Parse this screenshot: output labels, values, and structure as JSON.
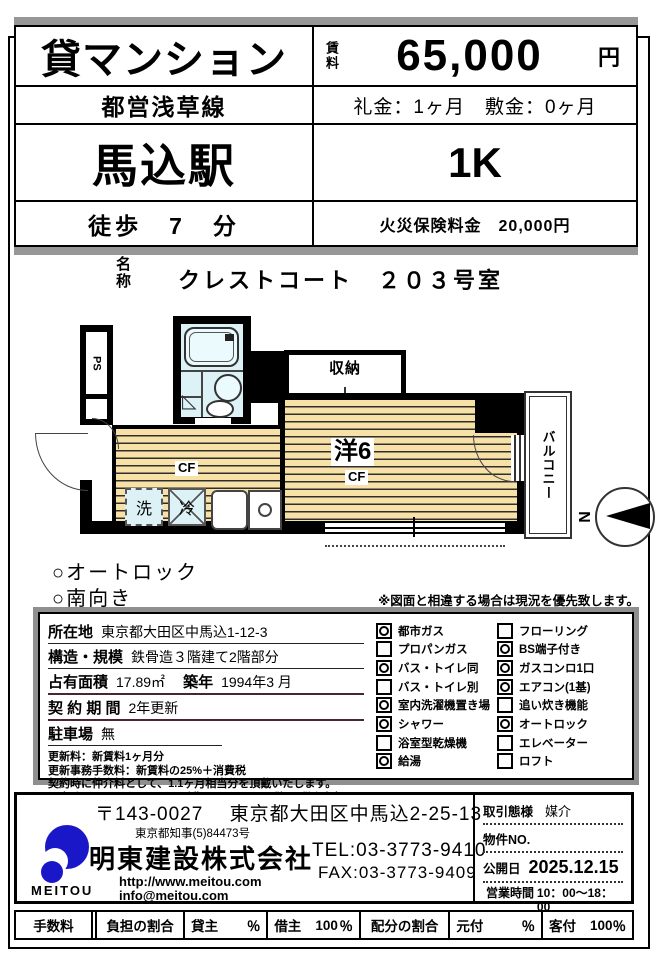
{
  "header": {
    "property_type": "貸マンション",
    "rent_label": "賃料",
    "rent_value": "65,000",
    "rent_unit": "円",
    "train_line": "都営浅草線",
    "key_money": "礼金：1ヶ月　敷金：0ヶ月",
    "station": "馬込駅",
    "layout": "1K",
    "walk": "徒歩　7　分",
    "fire_insurance": "火災保険料金　20,000円"
  },
  "name_section": {
    "label": "名称",
    "value": "クレストコート　２０３号室"
  },
  "floorplan": {
    "ps": "PS",
    "closet": "収納",
    "room": "洋6",
    "room_cf": "CF",
    "kitchen_cf": "CF",
    "balcony": "バルコニー",
    "washer": "洗",
    "fridge": "冷",
    "north": "N"
  },
  "features": {
    "item1": "○オートロック",
    "item2": "○南向き"
  },
  "disclaimer": "※図面と相違する場合は現況を優先致します。",
  "details": {
    "location_label": "所在地",
    "location": "東京都大田区中馬込1-12-3",
    "structure_label": "構造・規模",
    "structure": "鉄骨造３階建て2階部分",
    "area_label": "占有面積",
    "area": "17.89㎡",
    "built_label": "築年",
    "built": "1994年3 月",
    "contract_label": "契 約 期 間",
    "contract": "2年更新",
    "parking_label": "駐車場",
    "parking": "無",
    "notes": [
      "更新料：新賃料1ヶ月分",
      "更新事務手数料：新賃料の25%＋消費税",
      "契約時に仲介料として、1.1ヶ月相当分を頂戴いたします。",
      "退出時のハウスクリーニング費用(30,000円＋税) は借主負担です。"
    ],
    "checks_left": [
      {
        "label": "都市ガス",
        "checked": true
      },
      {
        "label": "プロパンガス",
        "checked": false
      },
      {
        "label": "バス・トイレ同",
        "checked": true
      },
      {
        "label": "バス・トイレ別",
        "checked": false
      },
      {
        "label": "室内洗濯機置き場",
        "checked": true
      },
      {
        "label": "シャワー",
        "checked": true
      },
      {
        "label": "浴室型乾燥機",
        "checked": false
      },
      {
        "label": "給湯",
        "checked": true
      }
    ],
    "checks_right": [
      {
        "label": "フローリング",
        "checked": false
      },
      {
        "label": "BS端子付き",
        "checked": true
      },
      {
        "label": "ガスコンロ1口",
        "checked": true
      },
      {
        "label": "エアコン(1基)",
        "checked": true
      },
      {
        "label": "追い炊き機能",
        "checked": false
      },
      {
        "label": "オートロック",
        "checked": true
      },
      {
        "label": "エレベーター",
        "checked": false
      },
      {
        "label": "ロフト",
        "checked": false
      }
    ]
  },
  "company": {
    "postal_address": "〒143-0027　 東京都大田区中馬込2-25-13",
    "license": "東京都知事(5)84473号",
    "name": "明東建設株式会社",
    "logo_text": "MEITOU",
    "website": "http://www.meitou.com",
    "email": "info@meitou.com",
    "tel": "TEL:03-3773-9410",
    "fax": "FAX:03-3773-9409",
    "deal_label": "取引態様",
    "deal_value": "媒介",
    "property_no_label": "物件NO.",
    "publish_label": "公開日",
    "publish_date": "2025.12.15",
    "hours_label": "営業時間",
    "hours_value": "10：00～18：00",
    "holiday_label": "定休日",
    "holiday_value": "水曜・祝日"
  },
  "footer": {
    "fee": "手数料",
    "burden": "負担の割合",
    "lessor": "貸主",
    "lessor_pct": "％",
    "tenant": "借主",
    "tenant_value": "100",
    "tenant_pct": "％",
    "alloc": "配分の割合",
    "moto": "元付",
    "moto_pct": "％",
    "kyaku": "客付",
    "kyaku_value": "100",
    "kyaku_pct": "％"
  }
}
